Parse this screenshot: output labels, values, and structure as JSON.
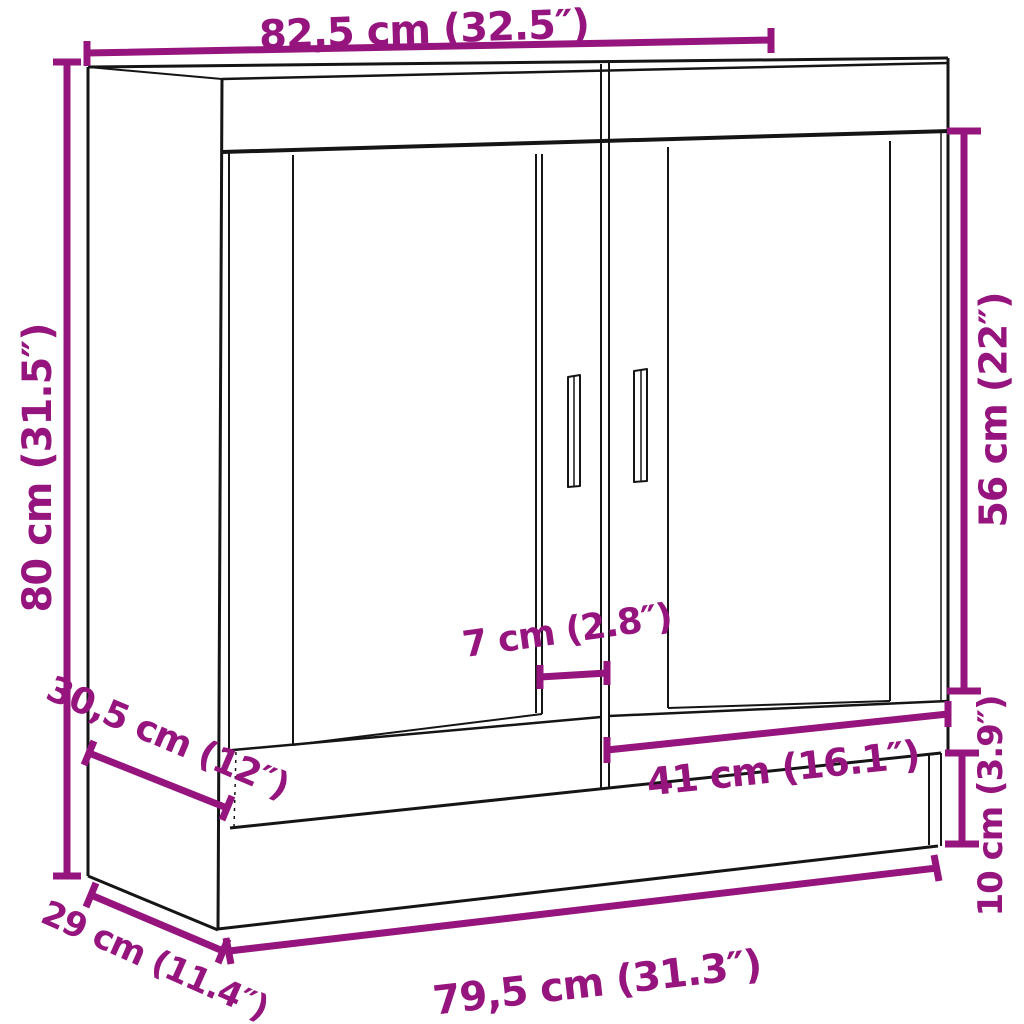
{
  "diagram": {
    "background_color": "#ffffff",
    "outline_color": "#151515",
    "dimension_color": "#96147E",
    "labels": {
      "top_width": "82,5 cm (32.5″)",
      "height": "80 cm (31.5″)",
      "door_glass_height": "56 cm (22″)",
      "center_stile_width": "7 cm (2.8″)",
      "door_width": "41 cm (16.1″)",
      "plinth_height": "10 cm (3.9″)",
      "top_depth": "30,5 cm (12″)",
      "bottom_depth": "29 cm (11.4″)",
      "bottom_width": "79,5 cm (31.3″)"
    }
  }
}
